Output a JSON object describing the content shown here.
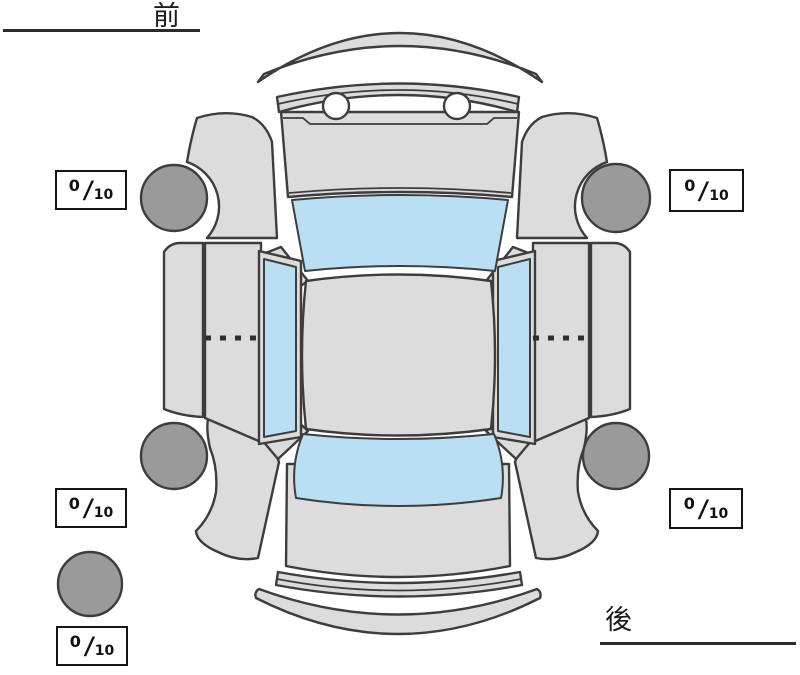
{
  "diagram": {
    "orientation_labels": {
      "front": "前",
      "rear": "後"
    },
    "tread_depth_boxes": [
      {
        "position": "front-left",
        "value": "0",
        "separator": "/",
        "max": "10"
      },
      {
        "position": "front-right",
        "value": "0",
        "separator": "/",
        "max": "10"
      },
      {
        "position": "rear-left",
        "value": "0",
        "separator": "/",
        "max": "10"
      },
      {
        "position": "rear-right",
        "value": "0",
        "separator": "/",
        "max": "10"
      },
      {
        "position": "spare",
        "value": "0",
        "separator": "/",
        "max": "10"
      }
    ],
    "colors": {
      "body": "#dcdcdc",
      "glass": "#badff5",
      "tire": "#9a9a9a",
      "outline": "#3d3d3d"
    }
  }
}
